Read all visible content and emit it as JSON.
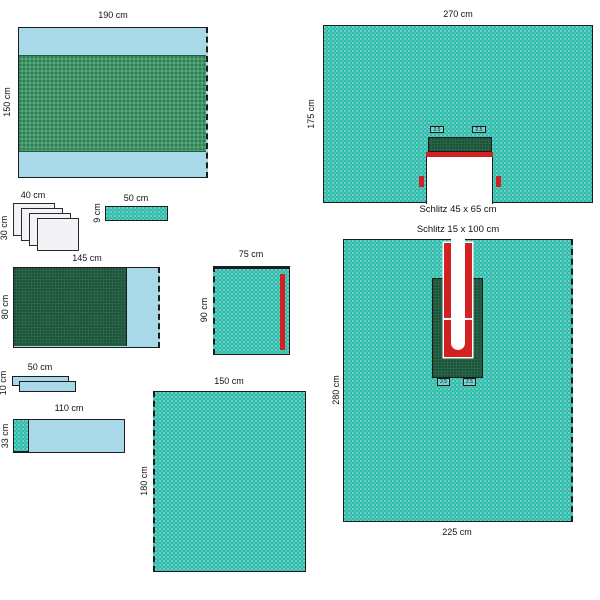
{
  "figure": {
    "type": "surgical-drape-set-diagram",
    "colors": {
      "teal": "#2fbcab",
      "light_blue": "#a9d9e9",
      "medium_green": "#3f9667",
      "dark_green": "#276549",
      "red": "#d32021",
      "outline": "#1c1c1c",
      "sheet_white": "#f3f3f7"
    },
    "items": {
      "drape_190x150": {
        "width": "190 cm",
        "height": "150 cm"
      },
      "drape_270x175": {
        "width": "270 cm",
        "height": "175 cm",
        "slit": "Schlitz 45 x 65 cm",
        "tape_left": "2.5",
        "tape_right": "2.5"
      },
      "towel_stack_40x30": {
        "width": "40 cm",
        "height": "30 cm"
      },
      "strip_50x9": {
        "width": "50 cm",
        "height": "9 cm"
      },
      "drape_145x80": {
        "width": "145 cm",
        "height": "80 cm"
      },
      "drape_75x90": {
        "width": "75 cm",
        "height": "90 cm"
      },
      "strip_stack_50x10": {
        "width": "50 cm",
        "height": "10 cm"
      },
      "strip_110x33": {
        "width": "110 cm",
        "height": "33 cm"
      },
      "drape_150x180": {
        "width": "150 cm",
        "height": "180 cm"
      },
      "drape_225x280": {
        "width": "225 cm",
        "height": "280 cm",
        "slit": "Schlitz 15 x 100 cm",
        "tape_left": "2.5",
        "tape_right": "2.5"
      }
    }
  }
}
